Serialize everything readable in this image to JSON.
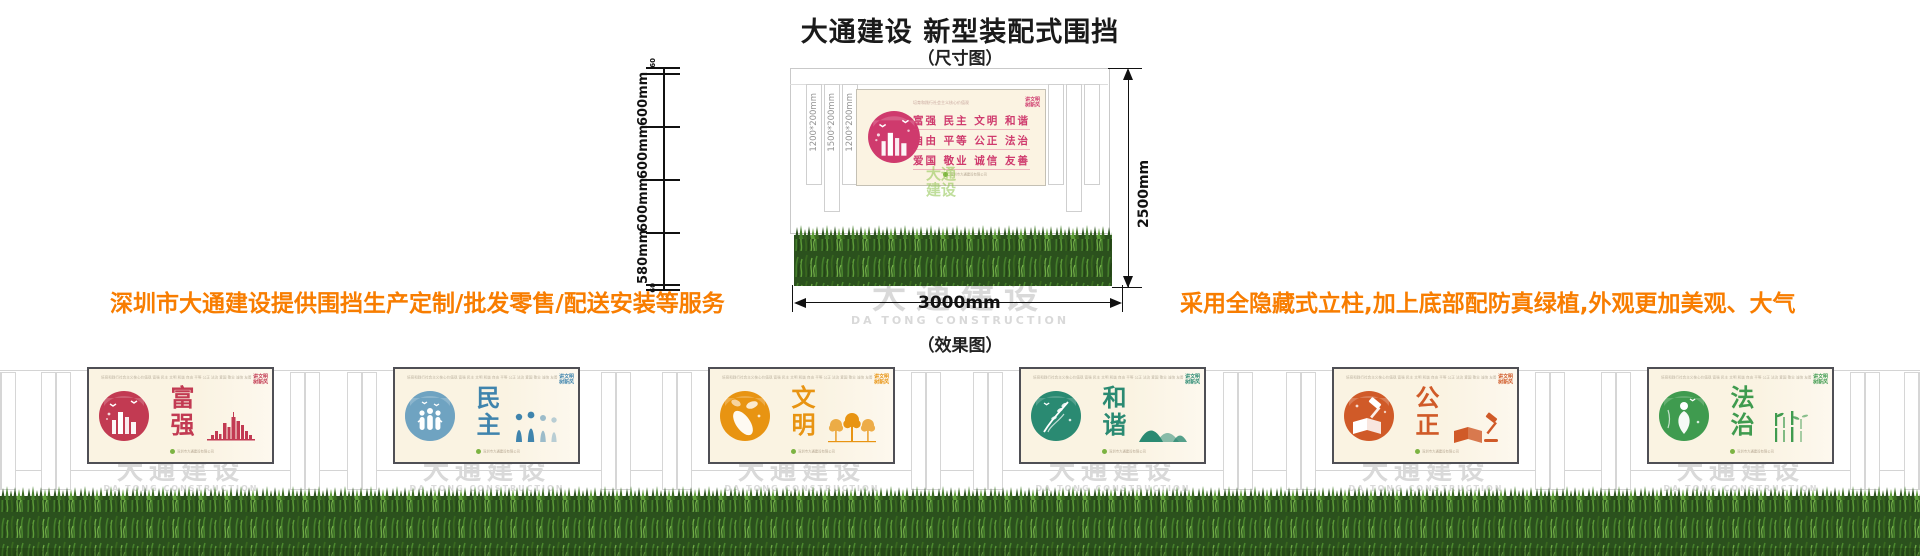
{
  "page": {
    "title": "大通建设 新型装配式围挡",
    "subtitle": "（尺寸图）",
    "effect_label": "（效果图）",
    "left_note": "深圳市大通建设提供围挡生产定制/批发零售/配送安装等服务",
    "right_note": "采用全隐藏式立柱,加上底部配防真绿植,外观更加美观、大气",
    "note_color": "#f87d00"
  },
  "watermark": {
    "cn": "大通建设",
    "en": "DA TONG CONSTRUCTION"
  },
  "dimension_diagram": {
    "left_dims": [
      "60",
      "600mm",
      "600mm",
      "600mm",
      "580mm",
      "60"
    ],
    "right_dim": "2500mm",
    "bottom_dim": "3000mm",
    "post_labels": [
      "1200*200mm",
      "1500*200mm",
      "1200*200mm"
    ],
    "billboard": {
      "header": "培育和践行社会主义核心价值观",
      "lines": [
        "富强 民主 文明 和谐",
        "自由 平等 公正 法治",
        "爱国 敬业 诚信 友善"
      ],
      "badge1": "讲文明",
      "badge2": "树新风",
      "footer": "深圳市大通建设有限公司",
      "accent": "#cf3a6d",
      "green_watermark1": "大通",
      "green_watermark2": "建设"
    }
  },
  "panel_common": {
    "header": "培育和践行社会主义核心价值观  富强 民主 文明 和谐 自由 平等 公正 法治 爱国 敬业 诚信 友善",
    "badge1": "讲文明",
    "badge2": "树新风",
    "footer": "深圳市大通建设有限公司"
  },
  "panels": [
    {
      "word": "富强",
      "accent": "#c23a52",
      "motif": "city-bars"
    },
    {
      "word": "民主",
      "accent": "#3f84ad",
      "motif": "people"
    },
    {
      "word": "文明",
      "accent": "#e89412",
      "motif": "trees"
    },
    {
      "word": "和谐",
      "accent": "#2a8a72",
      "motif": "mountains"
    },
    {
      "word": "公正",
      "accent": "#d05a28",
      "motif": "book-gavel"
    },
    {
      "word": "法治",
      "accent": "#3f9b4f",
      "motif": "bamboo"
    }
  ],
  "colors": {
    "hedge_dark": "#2b511d",
    "hedge_mid": "#457f2b",
    "hedge_light": "#5d9c38",
    "panel_bg": "#faf3e2",
    "watermark_gray": "#d9d9d9"
  }
}
